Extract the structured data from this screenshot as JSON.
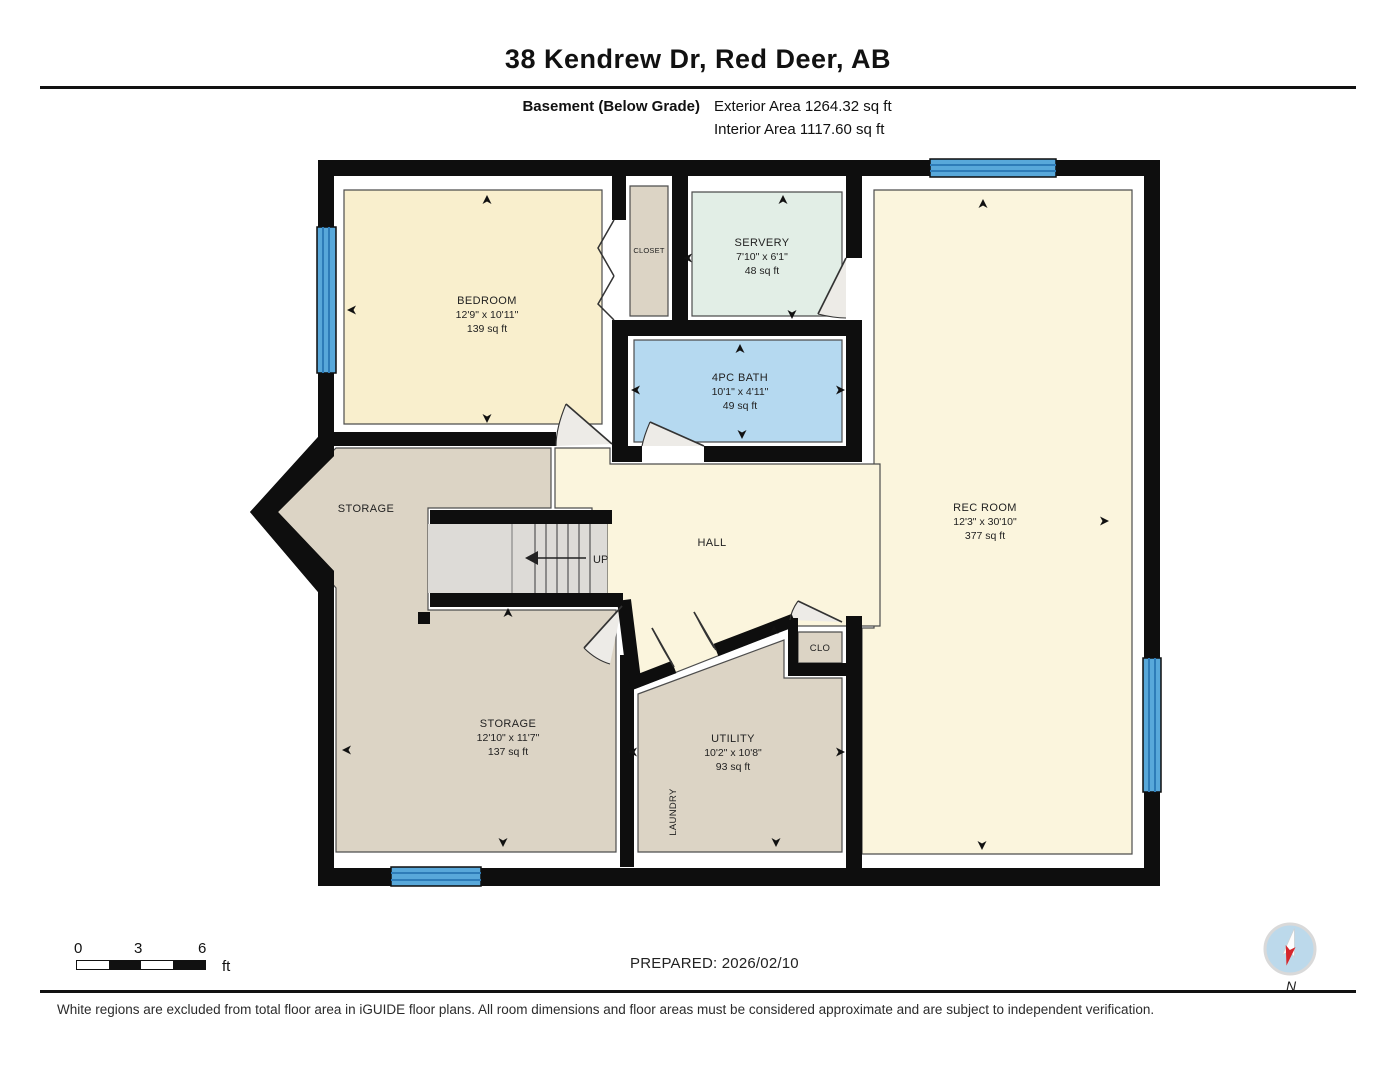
{
  "header": {
    "title": "38 Kendrew Dr, Red Deer, AB",
    "floor_label": "Basement (Below Grade)",
    "exterior_area": "Exterior Area 1264.32 sq ft",
    "interior_area": "Interior Area 1117.60 sq ft"
  },
  "rooms": {
    "bedroom": {
      "name": "BEDROOM",
      "dims": "12'9\" x 10'11\"",
      "area": "139 sq ft"
    },
    "closet": {
      "name": "CLOSET"
    },
    "servery": {
      "name": "SERVERY",
      "dims": "7'10\" x 6'1\"",
      "area": "48 sq ft"
    },
    "bath": {
      "name": "4PC BATH",
      "dims": "10'1\" x 4'11\"",
      "area": "49 sq ft"
    },
    "rec_room": {
      "name": "REC ROOM",
      "dims": "12'3\" x 30'10\"",
      "area": "377 sq ft"
    },
    "storage_upper": {
      "name": "STORAGE"
    },
    "hall": {
      "name": "HALL"
    },
    "stairs": {
      "label": "UP"
    },
    "storage_lower": {
      "name": "STORAGE",
      "dims": "12'10\" x 11'7\"",
      "area": "137 sq ft"
    },
    "utility": {
      "name": "UTILITY",
      "dims": "10'2\" x 10'8\"",
      "area": "93 sq ft"
    },
    "laundry": {
      "name": "LAUNDRY"
    },
    "clo": {
      "name": "CLO"
    }
  },
  "footer": {
    "scale": {
      "start": "0",
      "mid": "3",
      "end": "6",
      "unit": "ft"
    },
    "prepared": "PREPARED: 2026/02/10",
    "compass_label": "N",
    "disclaimer": "White regions are excluded from total floor area in iGUIDE floor plans. All room dimensions and floor areas must be considered approximate and are subject to independent verification."
  },
  "colors": {
    "room_yellow": "#f9efcd",
    "room_yellow_light": "#fbf5dd",
    "room_tan": "#dcd4c5",
    "room_mint": "#e2eee6",
    "room_blue": "#b5d9f0",
    "window_blue": "#58a8da",
    "wall": "#0e0e0e",
    "stairs_gray": "#dddbd7"
  }
}
